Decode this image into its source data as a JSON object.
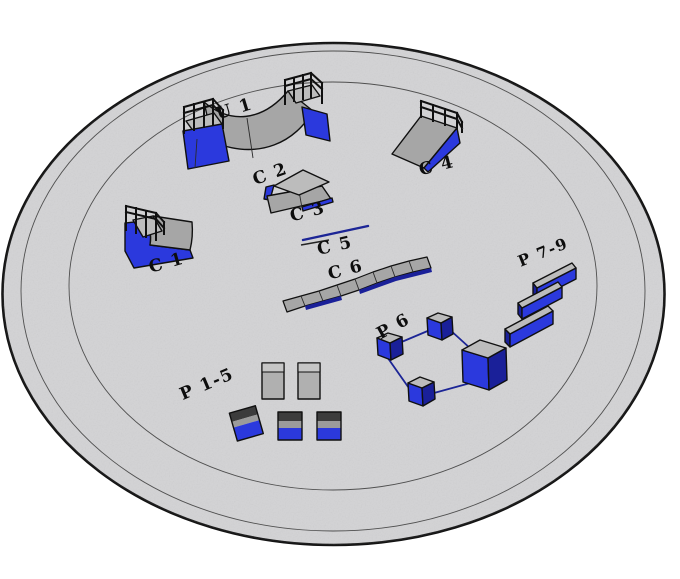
{
  "colors": {
    "background": "#ffffff",
    "pad_fill": "#d3d3d5",
    "pad_stroke": "#141414",
    "ring_stroke": "#4f4f4f",
    "obstacle_blue": "#2b39dd",
    "obstacle_blue_dark": "#1a2099",
    "surface_gray": "#a6a6a6",
    "surface_gray_dark": "#8f8f8f",
    "deck_gray_light": "#bcbcbc",
    "rail_navy": "#1c2596",
    "outline_black": "#101010"
  },
  "labels": {
    "u1": "U 1",
    "c1": "C 1",
    "c2": "C 2",
    "c3": "C 3",
    "c4": "C 4",
    "c5": "C 5",
    "c6": "C 6",
    "p15": "P 1-5",
    "p6": "P 6",
    "p79": "P 7-9"
  }
}
